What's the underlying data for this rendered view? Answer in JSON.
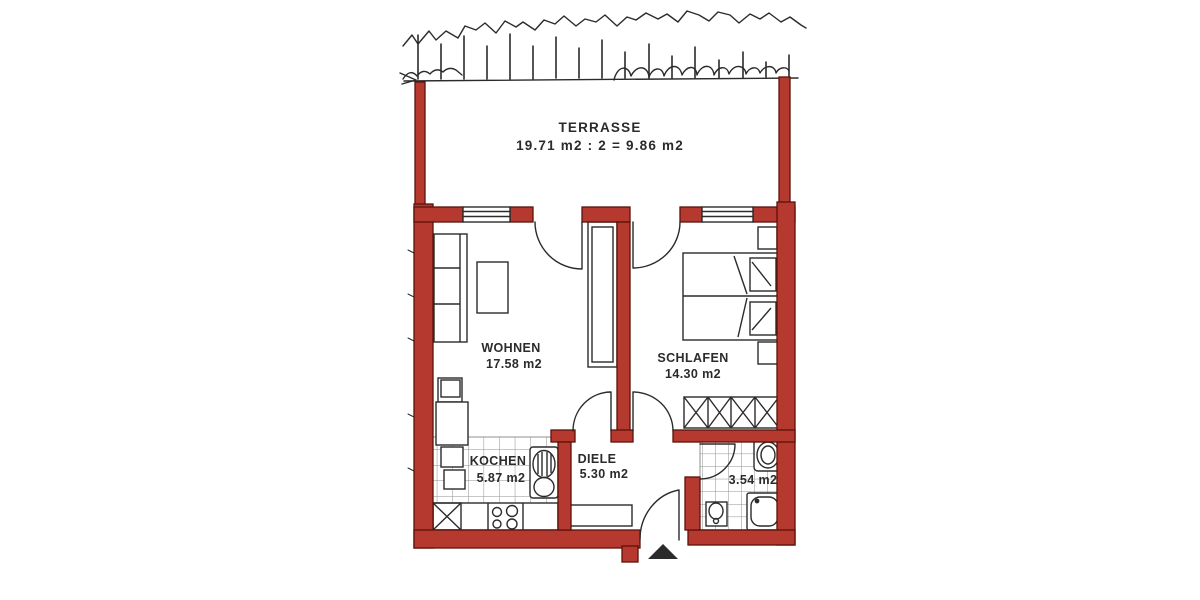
{
  "floorplan": {
    "rooms": [
      {
        "name": "TERRASSE",
        "area": "19.71 m2 : 2 = 9.86 m2"
      },
      {
        "name": "WOHNEN",
        "area": "17.58 m2"
      },
      {
        "name": "SCHLAFEN",
        "area": "14.30 m2"
      },
      {
        "name": "KOCHEN",
        "area": "5.87 m2"
      },
      {
        "name": "DIELE",
        "area": "5.30 m2"
      },
      {
        "name": "",
        "area": "3.54 m2"
      }
    ],
    "colors": {
      "wall": "#b5392e",
      "wall-edge": "#5a120b",
      "ink": "#2b2b2b",
      "paper": "#ffffff",
      "tile": "#8f8f8f"
    }
  }
}
